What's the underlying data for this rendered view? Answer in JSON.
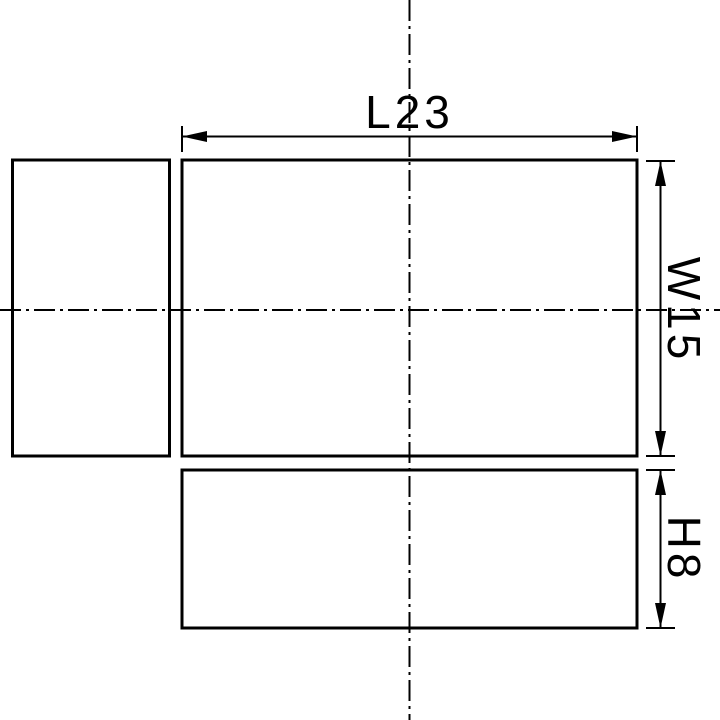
{
  "drawing": {
    "dimension_labels": {
      "length": "L23",
      "width": "W15",
      "height": "H8"
    },
    "colors": {
      "line": "#000000",
      "background": "#ffffff"
    }
  }
}
